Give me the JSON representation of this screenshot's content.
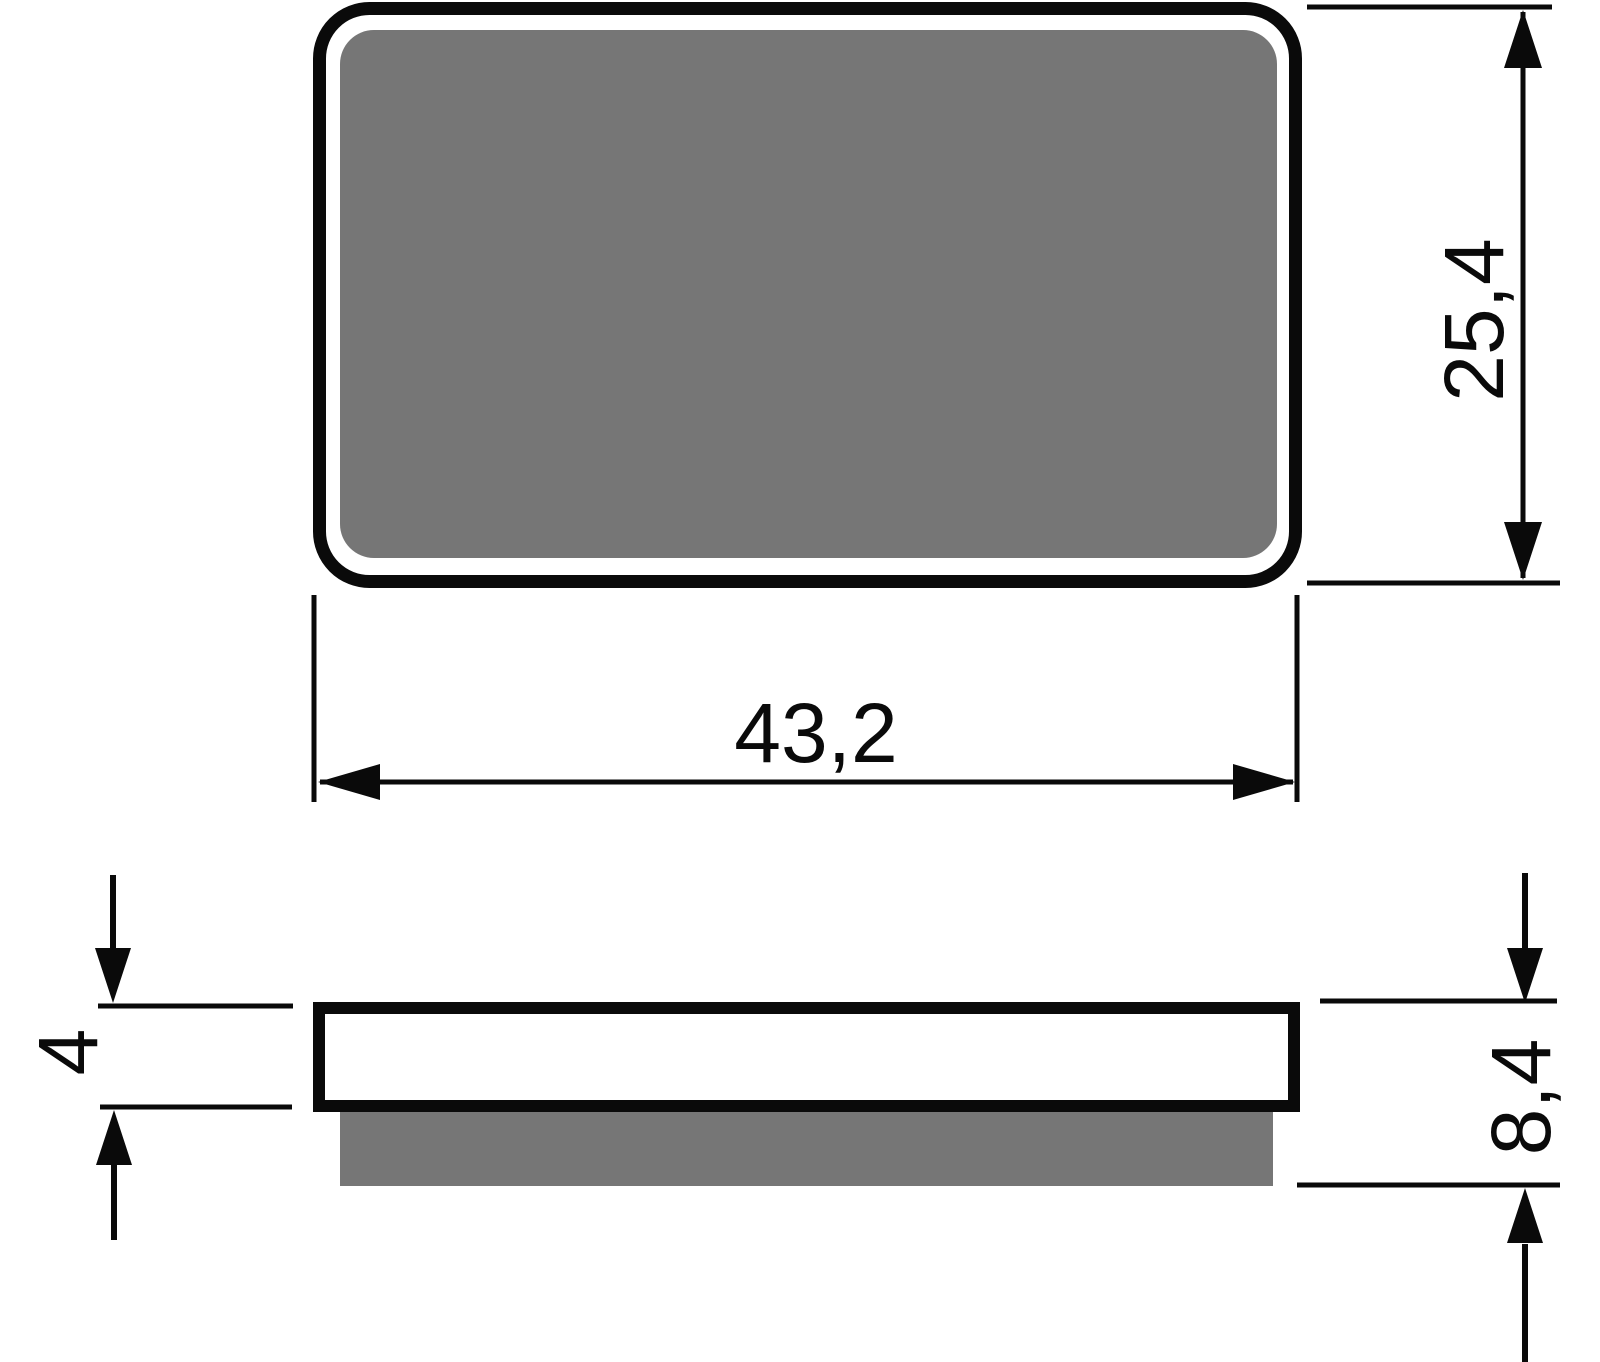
{
  "dimensions": {
    "width": {
      "value": "43,2"
    },
    "height": {
      "value": "25,4"
    },
    "backing_thickness": {
      "value": "4"
    },
    "total_thickness": {
      "value": "8,4"
    }
  },
  "colors": {
    "line": "#0a0a0a",
    "pad_fill": "#767676",
    "background": "#ffffff"
  }
}
